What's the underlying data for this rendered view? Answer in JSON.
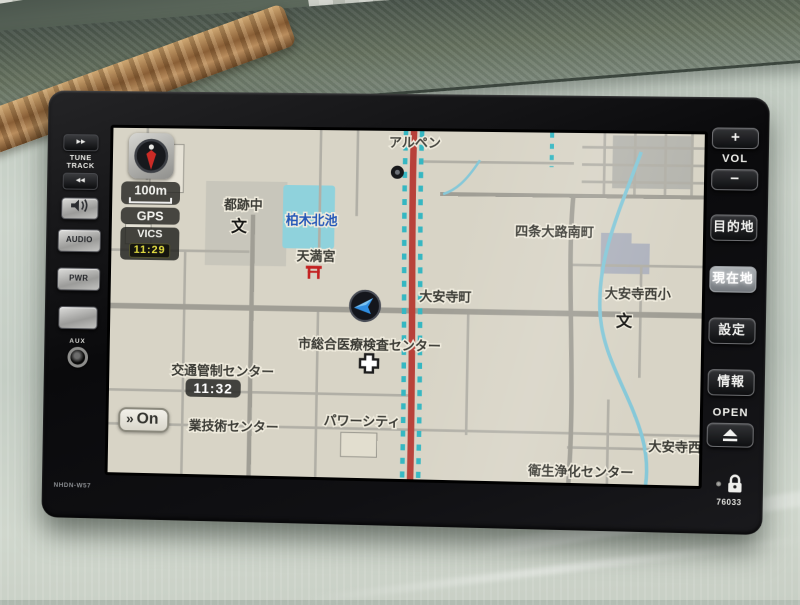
{
  "device": {
    "model_label": "NHDN-W57",
    "serial_label": "76033",
    "left_panel": {
      "track_up_icon": "▶▶",
      "tune_label_line1": "TUNE",
      "tune_label_line2": "TRACK",
      "track_down_icon": "◀◀",
      "audio_label": "AUDIO",
      "power_label": "PWR",
      "aux_label": "AUX"
    },
    "right_panel": {
      "volume_up_label": "+",
      "volume_label": "VOL",
      "volume_down_label": "−",
      "destination_label": "目的地",
      "current_position_label": "現在地",
      "settings_label": "設定",
      "info_label": "情報",
      "open_label": "OPEN"
    }
  },
  "nav_screen": {
    "status": {
      "scale_label": "100m",
      "gps_label": "GPS",
      "vics_label": "VICS",
      "vics_time": "11:29"
    },
    "clock_badge": "11:32",
    "congestion_button": {
      "icon": "»",
      "label": "On"
    },
    "map_labels": [
      {
        "id": "alpen",
        "text": "アルペン",
        "x": 304,
        "y": 16,
        "cls": "poi"
      },
      {
        "id": "miyakoato-junior-high",
        "text": "都跡中",
        "x": 133,
        "y": 80
      },
      {
        "id": "school-symbol-1",
        "text": "文",
        "x": 129,
        "y": 102,
        "cls": "school"
      },
      {
        "id": "kashiwagi-kitaike",
        "text": "柏木北池",
        "x": 202,
        "y": 94,
        "cls": "water"
      },
      {
        "id": "shijo-oji-minamimachi",
        "text": "四条大路南町",
        "x": 444,
        "y": 102
      },
      {
        "id": "tenmangu",
        "text": "天満宮",
        "x": 207,
        "y": 130
      },
      {
        "id": "daianji-cho",
        "text": "大安寺町",
        "x": 337,
        "y": 168
      },
      {
        "id": "daianji-nishi-elementary",
        "text": "大安寺西小",
        "x": 527,
        "y": 162
      },
      {
        "id": "school-symbol-2",
        "text": "文",
        "x": 514,
        "y": 190,
        "cls": "school"
      },
      {
        "id": "medical-center",
        "text": "市総合医療検査センター",
        "x": 262,
        "y": 217
      },
      {
        "id": "traffic-control-center",
        "text": "交通管制センター",
        "x": 115,
        "y": 246
      },
      {
        "id": "power-city",
        "text": "パワーシティ",
        "x": 256,
        "y": 293
      },
      {
        "id": "industrial-tech-center",
        "text": "業技術センター",
        "x": 127,
        "y": 301
      },
      {
        "id": "daianji-nishi",
        "text": "大安寺西",
        "x": 566,
        "y": 312
      },
      {
        "id": "eisei-joka-center",
        "text": "衛生浄化センター",
        "x": 474,
        "y": 338
      }
    ]
  },
  "map_colors": {
    "route": "#b8413a",
    "vics_marker": "#35b7c2",
    "water": "#8fd2dc",
    "background": "#d8d4c6"
  }
}
